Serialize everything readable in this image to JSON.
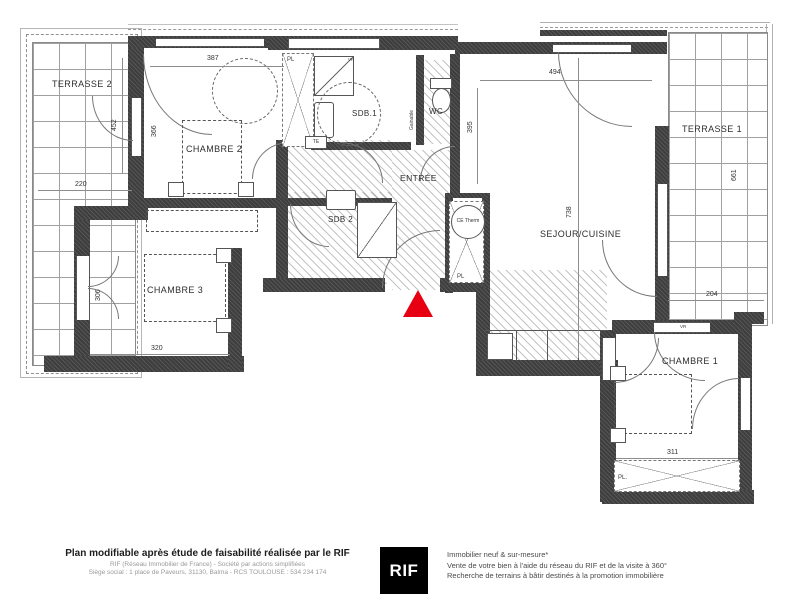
{
  "plan": {
    "rooms": {
      "terrasse2": "TERRASSE 2",
      "chambre2": "CHAMBRE 2",
      "sdb1": "SDB.1",
      "wc": "WC",
      "entree": "ENTRÉE",
      "sdb2": "SDB 2",
      "sejour": "SEJOUR/CUISINE",
      "chambre3": "CHAMBRE 3",
      "terrasse1": "TERRASSE 1",
      "chambre1": "CHAMBRE 1"
    },
    "dimensions": {
      "chambre2_width": "387",
      "chambre2_window": "366",
      "terrasse2_height": "452",
      "terrasse2_width": "220",
      "sejour_width": "494",
      "entree_height": "395",
      "sejour_height": "738",
      "chambre3_width": "320",
      "chambre3_door": "306",
      "terrasse1_width": "204",
      "terrasse1_height": "661",
      "chambre1_width": "311"
    },
    "annotations": {
      "closet_hall": "PL",
      "closet_entree": "PL",
      "closet_chambre1": "PL.",
      "te": "TE",
      "water_heater": "CE Therm",
      "gainable": "Gainable",
      "vr1": "VR",
      "vr2": "VR"
    },
    "marker_color": "#e60012"
  },
  "footer": {
    "left": {
      "title": "Plan modifiable après étude de faisabilité réalisée par le RIF",
      "line2": "RIF (Réseau Immobilier de France) - Société par actions simplifiées",
      "line3": "Siège social : 1 place de Paveurs, 31130, Balma - RCS TOULOUSE : 534 234 174"
    },
    "logo": "RIF",
    "right": {
      "line1": "Immobilier neuf & sur-mesure*",
      "line2": "Vente de votre bien à l'aide du réseau du RIF et de la visite à 360°",
      "line3": "Recherche de terrains à bâtir destinés à la promotion immobilière"
    }
  }
}
